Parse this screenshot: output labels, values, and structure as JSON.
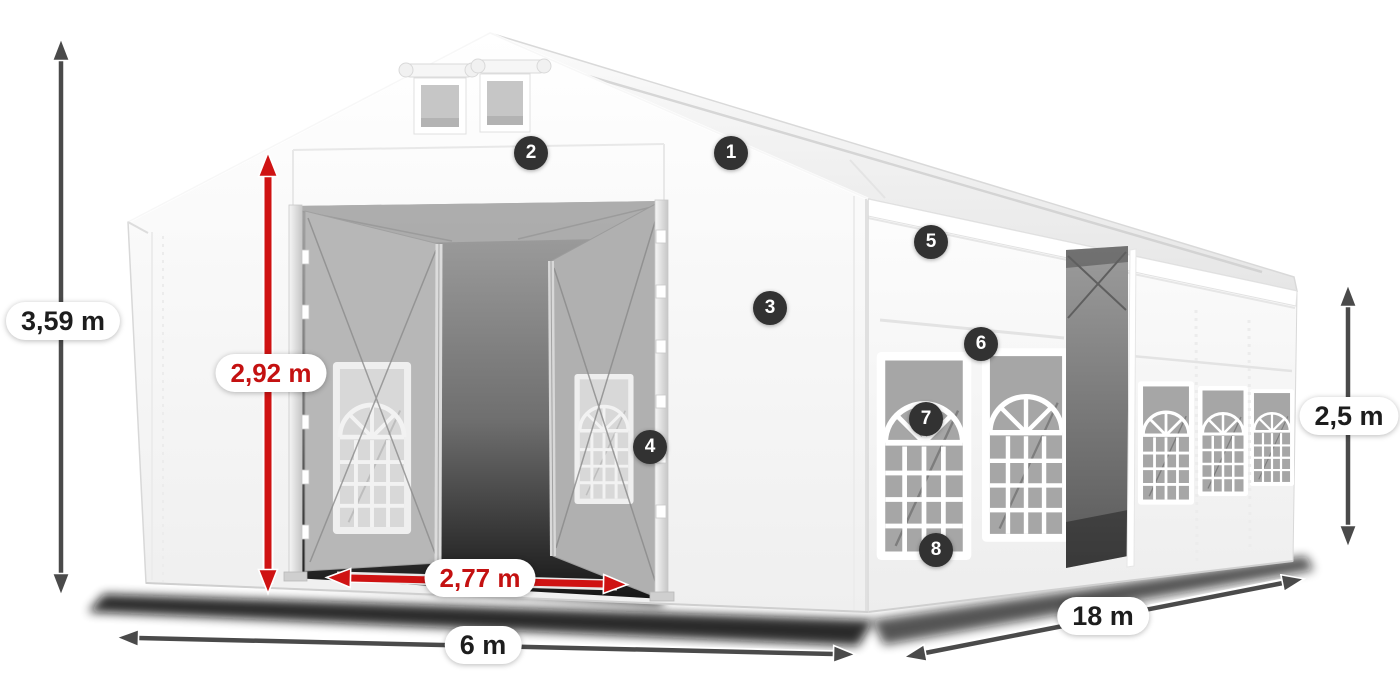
{
  "diagram": {
    "dimensions": {
      "total_height": {
        "label": "3,59 m",
        "style": "dark"
      },
      "entrance_height": {
        "label": "2,92 m",
        "style": "red"
      },
      "entrance_width": {
        "label": "2,77 m",
        "style": "red"
      },
      "front_width": {
        "label": "6 m",
        "style": "dark"
      },
      "side_length": {
        "label": "18 m",
        "style": "dark"
      },
      "wall_height": {
        "label": "2,5 m",
        "style": "dark"
      }
    },
    "markers": [
      {
        "number": "1"
      },
      {
        "number": "2"
      },
      {
        "number": "3"
      },
      {
        "number": "4"
      },
      {
        "number": "5"
      },
      {
        "number": "6"
      },
      {
        "number": "7"
      },
      {
        "number": "8"
      }
    ],
    "colors": {
      "dimension_arrow_dark": "#4a4a4a",
      "dimension_arrow_red": "#cf1313",
      "pill_background": "#ffffff",
      "pill_text_dark": "#1d1d1d",
      "pill_text_red": "#c41111",
      "marker_background": "#323232",
      "marker_number": "#ffffff",
      "tent_fabric": "#ffffff",
      "tent_shadow": "#0a0a0a"
    }
  }
}
